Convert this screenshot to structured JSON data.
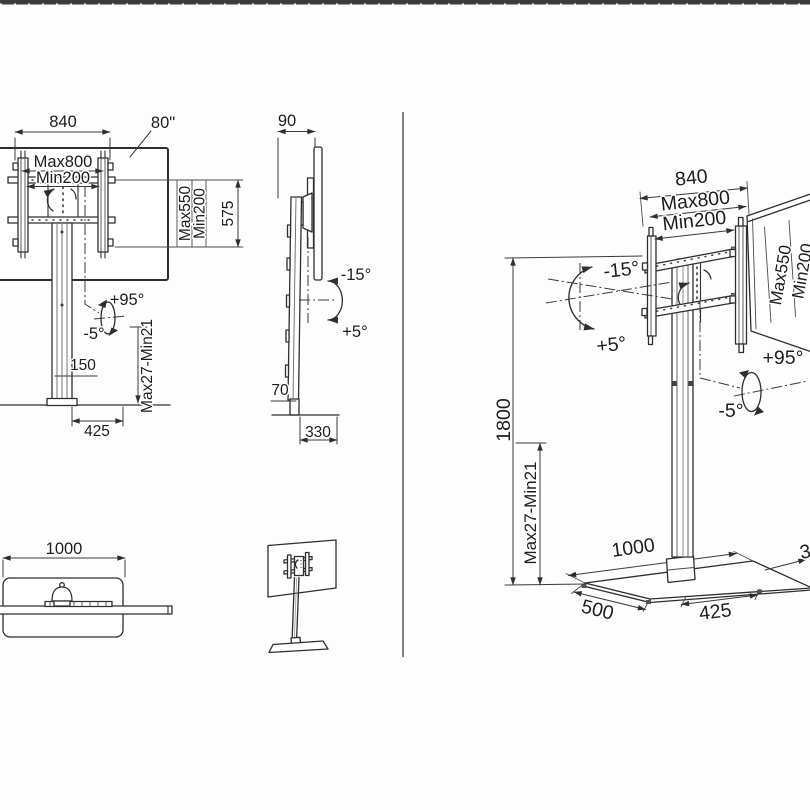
{
  "colors": {
    "ink": "#2e2e2e",
    "top_bar": "#3b3b3b",
    "background": "#fdfdfd"
  },
  "views": {
    "front": {
      "dim_width": "840",
      "screen_size": "80\"",
      "vesa_width_max": "Max800",
      "vesa_width_min": "Min200",
      "vesa_height_max": "Max550",
      "vesa_height_min": "Min200",
      "dim_bracket_height": "575",
      "swivel_plus": "+95°",
      "swivel_minus": "-5°",
      "dim_pole": "150",
      "height_range": "Max27-Min21",
      "dim_base_width": "425"
    },
    "side": {
      "dim_depth": "90",
      "tilt_down": "-15°",
      "tilt_up": "+5°",
      "dim_foot": "70",
      "dim_base_depth": "330"
    },
    "top": {
      "dim_base_width": "1000"
    },
    "iso": {
      "dim_width": "840",
      "vesa_width_max": "Max800",
      "vesa_width_min": "Min200",
      "vesa_height_max": "Max550",
      "vesa_height_min": "Min200",
      "tilt_down": "-15°",
      "tilt_up": "+5°",
      "swivel_plus": "+95°",
      "swivel_minus": "-5°",
      "dim_height": "1800",
      "height_range": "Max27-Min21",
      "dim_base_width": "1000",
      "dim_base_side": "500",
      "dim_base_half": "425",
      "dim_base_depth_clipped": "330"
    }
  }
}
